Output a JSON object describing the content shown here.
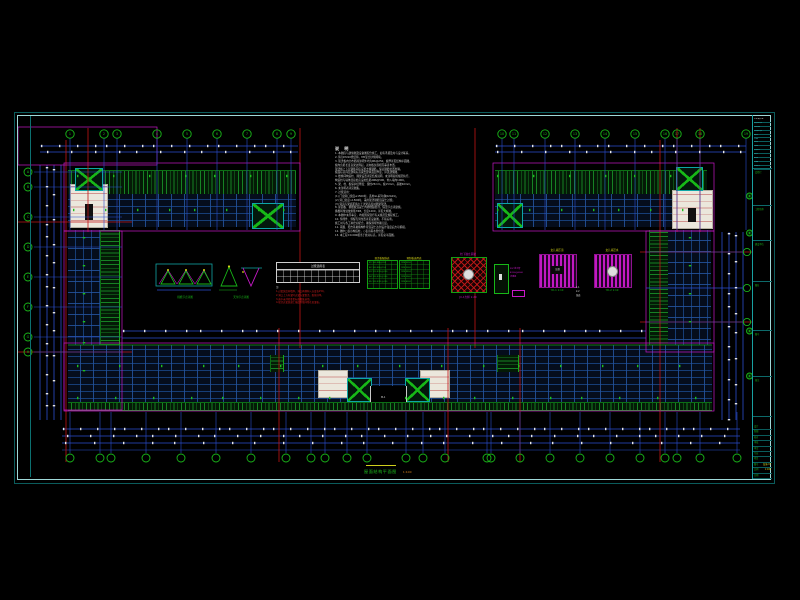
{
  "meta": {
    "type": "cad-structural-plan-sheet",
    "background": "#000000",
    "drawing_title": "屋面结构平面图",
    "drawing_scale": "1:100"
  },
  "colors": {
    "frame_bright": "#9fd9d9",
    "frame_dim": "#0b5c5c",
    "grid_blue": "#2b4ed0",
    "axis_red": "#c21616",
    "outline_magenta": "#c818c8",
    "hatch_green": "#168224",
    "bubble_green": "#19b619",
    "dim_text_white": "#e6e6e6",
    "note_yellow": "#d6d616",
    "cyan": "#12a4a4"
  },
  "notes": {
    "title": "说 明",
    "lines": [
      "1. 本图应与建施图及设备图配合施工，如有矛盾及时与设计联系。",
      "2. 砖为MU10烧结砖，M5混合砂浆砌筑。",
      "3. 现浇板内分布筋除注明外均为Φ6@250，板厚详见结构平面图。",
      "   板内负筋长度自梁边算起，双向板负筋相互垂直布置。",
      "   现浇板上下层钢筋间应设置支撑钢筋，保证钢筋位置准确。",
      "   板面标高同层建筑标高减去建筑面层厚度，详见建施图。",
      "4. 楼梯间构造柱、圈梁设置详见结施说明，未注明者按规范执行。",
      "   构造柱与墙体连接处应设拉结筋2Φ6@500，伸入墙内1000。",
      "5. 梁、柱、板保护层厚度：梁柱25mm，板15mm，基础40mm。",
      "6. 未注明者详见图集。",
      "7. 过梁选用：",
      "   (1) 门窗洞口宽度≤1500时，选用GL系列(陕02G01)。",
      "   (2) 洞口宽度>1500时，采用现浇钢筋混凝土过梁。",
      "   (3) 洞顶与梁底距离小于过梁高度时随梁现浇。",
      "8. 屋面板、挑檐板混凝土内掺微膨胀剂，保温节点详建施。",
      "   挑檐转角处放射筋7Φ8，长度1200，详见大样图。",
      "9. 本图中未尽事宜，均按国家现行有关规范及规程施工。",
      "10. 预埋件、预留孔洞位置详见设备图，不得后凿。",
      "    施工时与各工种密切配合，确保预埋准确无误。",
      "11. 雨蓬、阳台等悬挑构件待混凝土达到设计强度后方可拆模。",
      "12. 图中□表示构造柱，○表示雨水管位置。",
      "13. 本工程±0.000相当于绝对标高，详见总平面图。"
    ]
  },
  "details": {
    "d1_label": "挑檐节点详图",
    "d2_label": "天沟节点详图",
    "material_table": {
      "title": "过梁选用表",
      "notes": [
        {
          "text": "注:",
          "color": "white"
        },
        {
          "text": "1.过梁宽度同墙厚，洞口两侧伸入长度各250。",
          "color": "red"
        },
        {
          "text": "2.洞口上方有梁时过梁与梁整浇，配筋详单。",
          "color": "red"
        },
        {
          "text": "3.表中未列者参见标准图集选用。",
          "color": "red"
        },
        {
          "text": "4.现浇过梁混凝土强度等级同所在层梁板。",
          "color": "red"
        }
      ]
    },
    "gtable1": {
      "title": "现浇板配筋表",
      "rows": [
        "B1 100 Φ8@200",
        "B2 100 Φ8@150",
        "B3 110 Φ10@200",
        "B4 120 Φ10@150",
        "B5 120 Φ12@200"
      ]
    },
    "gtable2": {
      "title": "预制板选用表",
      "rows": [
        "YKB 3352",
        "YKB 3362",
        "YKB 3952",
        "YKB 3962",
        "YKB 4262"
      ]
    },
    "base_detail": {
      "top_label": "柱下独立基础",
      "bottom_label": "JC-1大样 1:20"
    },
    "col_detail": {
      "labels": [
        "PVC排水管",
        "Φ100@6000",
        "详建施"
      ]
    },
    "parapet1": {
      "top_label": "女儿墙压顶",
      "center": "压顶",
      "bottom_label": "YD-1  1:10"
    },
    "parapet2": {
      "top_label": "女儿墙泛水",
      "bottom_label": "YD-2  1:10"
    },
    "sections": [
      "1-1",
      "2-2",
      "剖面"
    ],
    "entry_label": "M-1"
  },
  "title_block": {
    "top_rows": [
      "××设计院",
      "资质证书",
      "注册章",
      "修改记录",
      "版次",
      "日期",
      "签名",
      "专业",
      "负责人",
      "审定",
      "批准",
      "出图",
      "存档号"
    ],
    "cells": [
      {
        "y": 168,
        "label": "会签栏"
      },
      {
        "y": 205,
        "label": "工程名称"
      },
      {
        "y": 240,
        "label": "建设单位"
      },
      {
        "y": 281,
        "label": "图名"
      },
      {
        "y": 330,
        "label": "图号"
      },
      {
        "y": 376,
        "label": "备注"
      },
      {
        "y": 416,
        "label": ""
      }
    ],
    "bottom_rows": [
      {
        "left": "设计",
        "right": ""
      },
      {
        "left": "制图",
        "right": ""
      },
      {
        "left": "校对",
        "right": ""
      },
      {
        "left": "审核",
        "right": ""
      },
      {
        "left": "审定",
        "right": ""
      },
      {
        "left": "专业",
        "right": ""
      },
      {
        "left": "项目",
        "right": ""
      },
      {
        "left": "图号",
        "right": "结施-03"
      },
      {
        "left": "比例",
        "right": "1:100"
      },
      {
        "left": "日期",
        "right": ""
      }
    ]
  },
  "geometry": {
    "lines": [
      {
        "x1": 40,
        "y1": 146,
        "x2": 298,
        "y2": 146,
        "c": "#2b4ed0"
      },
      {
        "x1": 40,
        "y1": 152,
        "x2": 298,
        "y2": 152,
        "c": "#2b4ed0"
      },
      {
        "x1": 495,
        "y1": 146,
        "x2": 746,
        "y2": 146,
        "c": "#2b4ed0"
      },
      {
        "x1": 495,
        "y1": 152,
        "x2": 746,
        "y2": 152,
        "c": "#2b4ed0"
      },
      {
        "x1": 62,
        "y1": 429,
        "x2": 740,
        "y2": 429,
        "c": "#2b4ed0"
      },
      {
        "x1": 62,
        "y1": 436,
        "x2": 740,
        "y2": 436,
        "c": "#2b4ed0"
      },
      {
        "x1": 62,
        "y1": 443,
        "x2": 740,
        "y2": 443,
        "c": "#2b4ed0"
      },
      {
        "x1": 62,
        "y1": 450,
        "x2": 740,
        "y2": 450,
        "c": "#2b4ed0",
        "w": 0.5
      },
      {
        "x1": 40,
        "y1": 165,
        "x2": 40,
        "y2": 420,
        "c": "#2b4ed0"
      },
      {
        "x1": 47,
        "y1": 165,
        "x2": 47,
        "y2": 420,
        "c": "#2b4ed0"
      },
      {
        "x1": 54,
        "y1": 165,
        "x2": 54,
        "y2": 420,
        "c": "#2b4ed0"
      },
      {
        "x1": 61,
        "y1": 165,
        "x2": 61,
        "y2": 420,
        "c": "#2b4ed0"
      },
      {
        "x1": 722,
        "y1": 232,
        "x2": 722,
        "y2": 420,
        "c": "#2b4ed0"
      },
      {
        "x1": 729,
        "y1": 232,
        "x2": 729,
        "y2": 420,
        "c": "#2b4ed0"
      },
      {
        "x1": 736,
        "y1": 232,
        "x2": 736,
        "y2": 420,
        "c": "#2b4ed0"
      },
      {
        "x1": 743,
        "y1": 232,
        "x2": 743,
        "y2": 420,
        "c": "#2b4ed0"
      },
      {
        "x1": 122,
        "y1": 331,
        "x2": 646,
        "y2": 331,
        "c": "#2b4ed0"
      },
      {
        "x1": 122,
        "y1": 338,
        "x2": 646,
        "y2": 338,
        "c": "#2b4ed0"
      },
      {
        "x1": 66,
        "y1": 140,
        "x2": 66,
        "y2": 462,
        "c": "#c21616"
      },
      {
        "x1": 88,
        "y1": 128,
        "x2": 88,
        "y2": 232,
        "c": "#c21616"
      },
      {
        "x1": 300,
        "y1": 128,
        "x2": 300,
        "y2": 348,
        "c": "#c21616"
      },
      {
        "x1": 475,
        "y1": 128,
        "x2": 475,
        "y2": 348,
        "c": "#c21616"
      },
      {
        "x1": 279,
        "y1": 328,
        "x2": 279,
        "y2": 462,
        "c": "#c21616"
      },
      {
        "x1": 448,
        "y1": 328,
        "x2": 448,
        "y2": 462,
        "c": "#c21616"
      },
      {
        "x1": 520,
        "y1": 328,
        "x2": 520,
        "y2": 462,
        "c": "#c21616"
      },
      {
        "x1": 660,
        "y1": 140,
        "x2": 660,
        "y2": 462,
        "c": "#c21616"
      },
      {
        "x1": 677,
        "y1": 128,
        "x2": 677,
        "y2": 232,
        "c": "#c21616"
      },
      {
        "x1": 700,
        "y1": 128,
        "x2": 700,
        "y2": 232,
        "c": "#c21616"
      },
      {
        "x1": 18,
        "y1": 222,
        "x2": 132,
        "y2": 222,
        "c": "#c21616"
      },
      {
        "x1": 18,
        "y1": 352,
        "x2": 132,
        "y2": 352,
        "c": "#c21616"
      },
      {
        "x1": 640,
        "y1": 252,
        "x2": 752,
        "y2": 252,
        "c": "#c21616"
      },
      {
        "x1": 640,
        "y1": 322,
        "x2": 752,
        "y2": 322,
        "c": "#c21616"
      },
      {
        "x1": 646,
        "y1": 288,
        "x2": 743,
        "y2": 288,
        "c": "#2b4ed0",
        "w": 0.6
      },
      {
        "x1": 68,
        "y1": 345,
        "x2": 712,
        "y2": 345,
        "c": "#14a614",
        "w": 0.7
      }
    ],
    "rects": [
      {
        "x": 64,
        "y": 163,
        "w": 236,
        "h": 68,
        "c": "#c818c8"
      },
      {
        "x": 493,
        "y": 163,
        "w": 221,
        "h": 68,
        "c": "#c818c8"
      },
      {
        "x": 64,
        "y": 231,
        "w": 58,
        "h": 179,
        "c": "#c818c8"
      },
      {
        "x": 646,
        "y": 231,
        "w": 68,
        "h": 121,
        "c": "#c818c8"
      },
      {
        "x": 64,
        "y": 343,
        "w": 650,
        "h": 68,
        "c": "#c818c8"
      },
      {
        "x": 18,
        "y": 127,
        "w": 139,
        "h": 38,
        "c": "#c818c8"
      }
    ],
    "bubble_groups": [
      {
        "cy": 134,
        "r": 4.2,
        "xs": [
          70,
          104,
          117,
          157,
          187,
          217,
          247,
          277,
          291
        ],
        "labels": [
          "1",
          "2",
          "3",
          "4",
          "5",
          "6",
          "7",
          "8",
          "9"
        ],
        "drop_from": 138,
        "drop_to": 230
      },
      {
        "cy": 134,
        "r": 4.2,
        "xs": [
          502,
          514,
          545,
          575,
          605,
          635,
          665,
          677,
          700,
          746
        ],
        "labels": [
          "10",
          "11",
          "12",
          "13",
          "14",
          "15",
          "16",
          "17",
          "18",
          "19"
        ],
        "drop_from": 138,
        "drop_to": 230
      },
      {
        "cy": 458,
        "r": 4,
        "xs": [
          70,
          100,
          111,
          146,
          181,
          216,
          251,
          286,
          311,
          325,
          347,
          367,
          406,
          423,
          445,
          487,
          491,
          520,
          550,
          580,
          610,
          640,
          665,
          677,
          700,
          737
        ],
        "labels": [],
        "drop_from": 412,
        "drop_to": 453
      },
      {
        "cx": 28,
        "r": 4,
        "ys": [
          172,
          187,
          217,
          247,
          277,
          307,
          337,
          352
        ],
        "labels": [
          "A",
          "B",
          "C",
          "D",
          "E",
          "F",
          "G",
          "H"
        ],
        "drop_from": 34,
        "drop_to": 122
      },
      {
        "cx": 747,
        "r": 3.6,
        "ys": [
          252,
          288,
          322
        ],
        "labels": [],
        "drop_from": 646,
        "drop_to": 743
      },
      {
        "cx": 749.5,
        "r": 3,
        "ys": [
          196,
          233,
          331,
          376
        ],
        "labels": [],
        "stamp": true
      }
    ],
    "tick_runs": [
      {
        "y": 146,
        "from": 44,
        "to": 294,
        "step": 16
      },
      {
        "y": 146,
        "from": 499,
        "to": 742,
        "step": 16
      },
      {
        "y": 152,
        "from": 50,
        "to": 294,
        "step": 22
      },
      {
        "y": 152,
        "from": 500,
        "to": 742,
        "step": 22
      },
      {
        "y": 429,
        "from": 66,
        "to": 736,
        "step": 15
      },
      {
        "y": 436,
        "from": 70,
        "to": 736,
        "step": 21
      },
      {
        "y": 443,
        "from": 68,
        "to": 736,
        "step": 27
      },
      {
        "y": 331,
        "from": 126,
        "to": 642,
        "step": 19
      },
      {
        "x": 47,
        "from": 170,
        "to": 416,
        "step": 17,
        "vert": true
      },
      {
        "x": 54,
        "from": 172,
        "to": 416,
        "step": 23,
        "vert": true
      },
      {
        "x": 729,
        "from": 236,
        "to": 416,
        "step": 18,
        "vert": true
      },
      {
        "x": 736,
        "from": 238,
        "to": 416,
        "step": 24,
        "vert": true
      },
      {
        "y": 176,
        "from": 80,
        "to": 290,
        "step": 34,
        "c": "#1dc01d"
      },
      {
        "y": 176,
        "from": 500,
        "to": 700,
        "step": 34,
        "c": "#1dc01d"
      },
      {
        "y": 210,
        "from": 76,
        "to": 292,
        "step": 30,
        "c": "#1dc01d"
      },
      {
        "y": 210,
        "from": 500,
        "to": 706,
        "step": 30,
        "c": "#1dc01d"
      },
      {
        "y": 366,
        "from": 80,
        "to": 700,
        "step": 40,
        "c": "#1dc01d"
      },
      {
        "y": 398,
        "from": 80,
        "to": 700,
        "step": 36,
        "c": "#1dc01d"
      },
      {
        "x": 84,
        "from": 240,
        "to": 370,
        "step": 26,
        "vert": true,
        "c": "#1dc01d"
      },
      {
        "x": 690,
        "from": 240,
        "to": 340,
        "step": 26,
        "vert": true,
        "c": "#1dc01d"
      }
    ],
    "areas": [
      {
        "n": "wing-topleft-roofband",
        "cls": "hatchv",
        "x": 68,
        "y": 170,
        "w": 228,
        "h": 24
      },
      {
        "n": "wing-topleft-floor",
        "cls": "floor",
        "x": 68,
        "y": 194,
        "w": 228,
        "h": 33
      },
      {
        "n": "wing-topleft-stair",
        "cls": "whiteblk door",
        "x": 70,
        "y": 184,
        "w": 36,
        "h": 42
      },
      {
        "n": "wing-topleft-hatchsq-1",
        "cls": "xsq",
        "x": 75,
        "y": 168,
        "w": 26,
        "h": 21
      },
      {
        "n": "wing-topleft-hatchsq-2",
        "cls": "xsq",
        "x": 252,
        "y": 203,
        "w": 30,
        "h": 24
      },
      {
        "n": "wing-topright-roofband",
        "cls": "hatchv",
        "x": 495,
        "y": 170,
        "w": 212,
        "h": 24
      },
      {
        "n": "wing-topright-floor",
        "cls": "floor",
        "x": 495,
        "y": 194,
        "w": 212,
        "h": 33
      },
      {
        "n": "wing-topright-stair",
        "cls": "whiteblk door",
        "x": 672,
        "y": 190,
        "w": 39,
        "h": 37
      },
      {
        "n": "wing-topright-hatchsq-1",
        "cls": "xsq",
        "x": 497,
        "y": 203,
        "w": 24,
        "h": 23
      },
      {
        "n": "wing-topright-hatchsq-2",
        "cls": "xsq",
        "x": 676,
        "y": 167,
        "w": 25,
        "h": 22
      },
      {
        "n": "wing-left-floor",
        "cls": "floorv",
        "x": 68,
        "y": 230,
        "w": 32,
        "h": 150
      },
      {
        "n": "wing-left-roofband",
        "cls": "hatchh",
        "x": 100,
        "y": 230,
        "w": 18,
        "h": 148
      },
      {
        "n": "wing-left-hatchsq",
        "cls": "xsq",
        "x": 76,
        "y": 362,
        "w": 21,
        "h": 18
      },
      {
        "n": "wing-left-stair",
        "cls": "whiteblk door",
        "x": 69,
        "y": 379,
        "w": 35,
        "h": 28
      },
      {
        "n": "wing-right-roofband",
        "cls": "hatchh",
        "x": 649,
        "y": 230,
        "w": 18,
        "h": 120
      },
      {
        "n": "wing-right-floor",
        "cls": "floorv",
        "x": 668,
        "y": 230,
        "w": 43,
        "h": 120
      },
      {
        "n": "wing-bottom-floor",
        "cls": "floor",
        "x": 68,
        "y": 345,
        "w": 644,
        "h": 60
      },
      {
        "n": "wing-bottom-stair-1",
        "cls": "whiteblk",
        "x": 318,
        "y": 370,
        "w": 28,
        "h": 26
      },
      {
        "n": "wing-bottom-stair-2",
        "cls": "whiteblk",
        "x": 420,
        "y": 370,
        "w": 28,
        "h": 26
      },
      {
        "n": "wing-bottom-hatchsq-1",
        "cls": "xsq",
        "x": 347,
        "y": 378,
        "w": 23,
        "h": 22
      },
      {
        "n": "wing-bottom-hatchsq-2",
        "cls": "xsq",
        "x": 405,
        "y": 378,
        "w": 23,
        "h": 22
      },
      {
        "n": "wing-bottom-entry",
        "cls": "entry",
        "x": 370,
        "y": 386,
        "w": 35,
        "h": 24
      },
      {
        "n": "wing-bottom-greenband-left",
        "cls": "hatchh",
        "x": 270,
        "y": 355,
        "w": 12,
        "h": 17
      },
      {
        "n": "wing-bottom-greenband-right",
        "cls": "hatchh",
        "x": 497,
        "y": 355,
        "w": 20,
        "h": 17
      },
      {
        "n": "wing-bottom-eaveticks",
        "cls": "hatchv",
        "x": 68,
        "y": 402,
        "w": 644,
        "h": 7
      }
    ]
  }
}
